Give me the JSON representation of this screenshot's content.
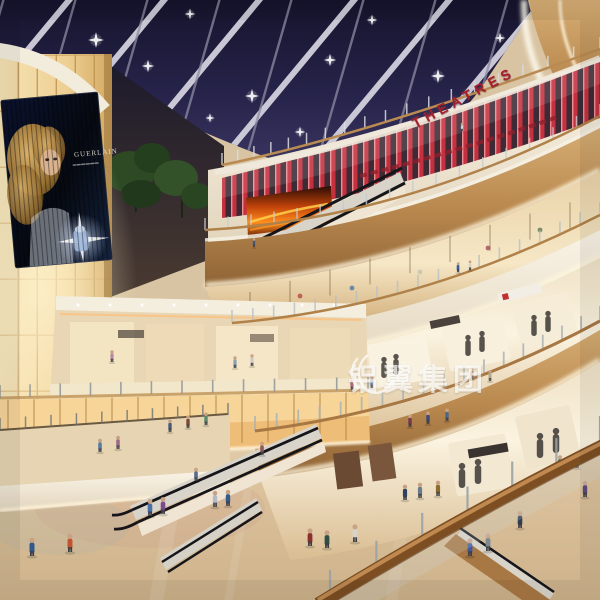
{
  "signs": {
    "theatres": "THEATRES"
  },
  "billboard": {
    "brand": "GUERLAIN"
  },
  "watermark": {
    "text": "铝翼集团"
  },
  "colors": {
    "skylight": "#211f3a",
    "beam": "#d8d6e2",
    "theatre_red": "#c22737",
    "fascia_cream": "#f2ead9",
    "wood": "#b98a52",
    "panel_amber": "#f2d9a4",
    "floor": "#dcc6a4",
    "watermark_white": "#ffffff"
  }
}
